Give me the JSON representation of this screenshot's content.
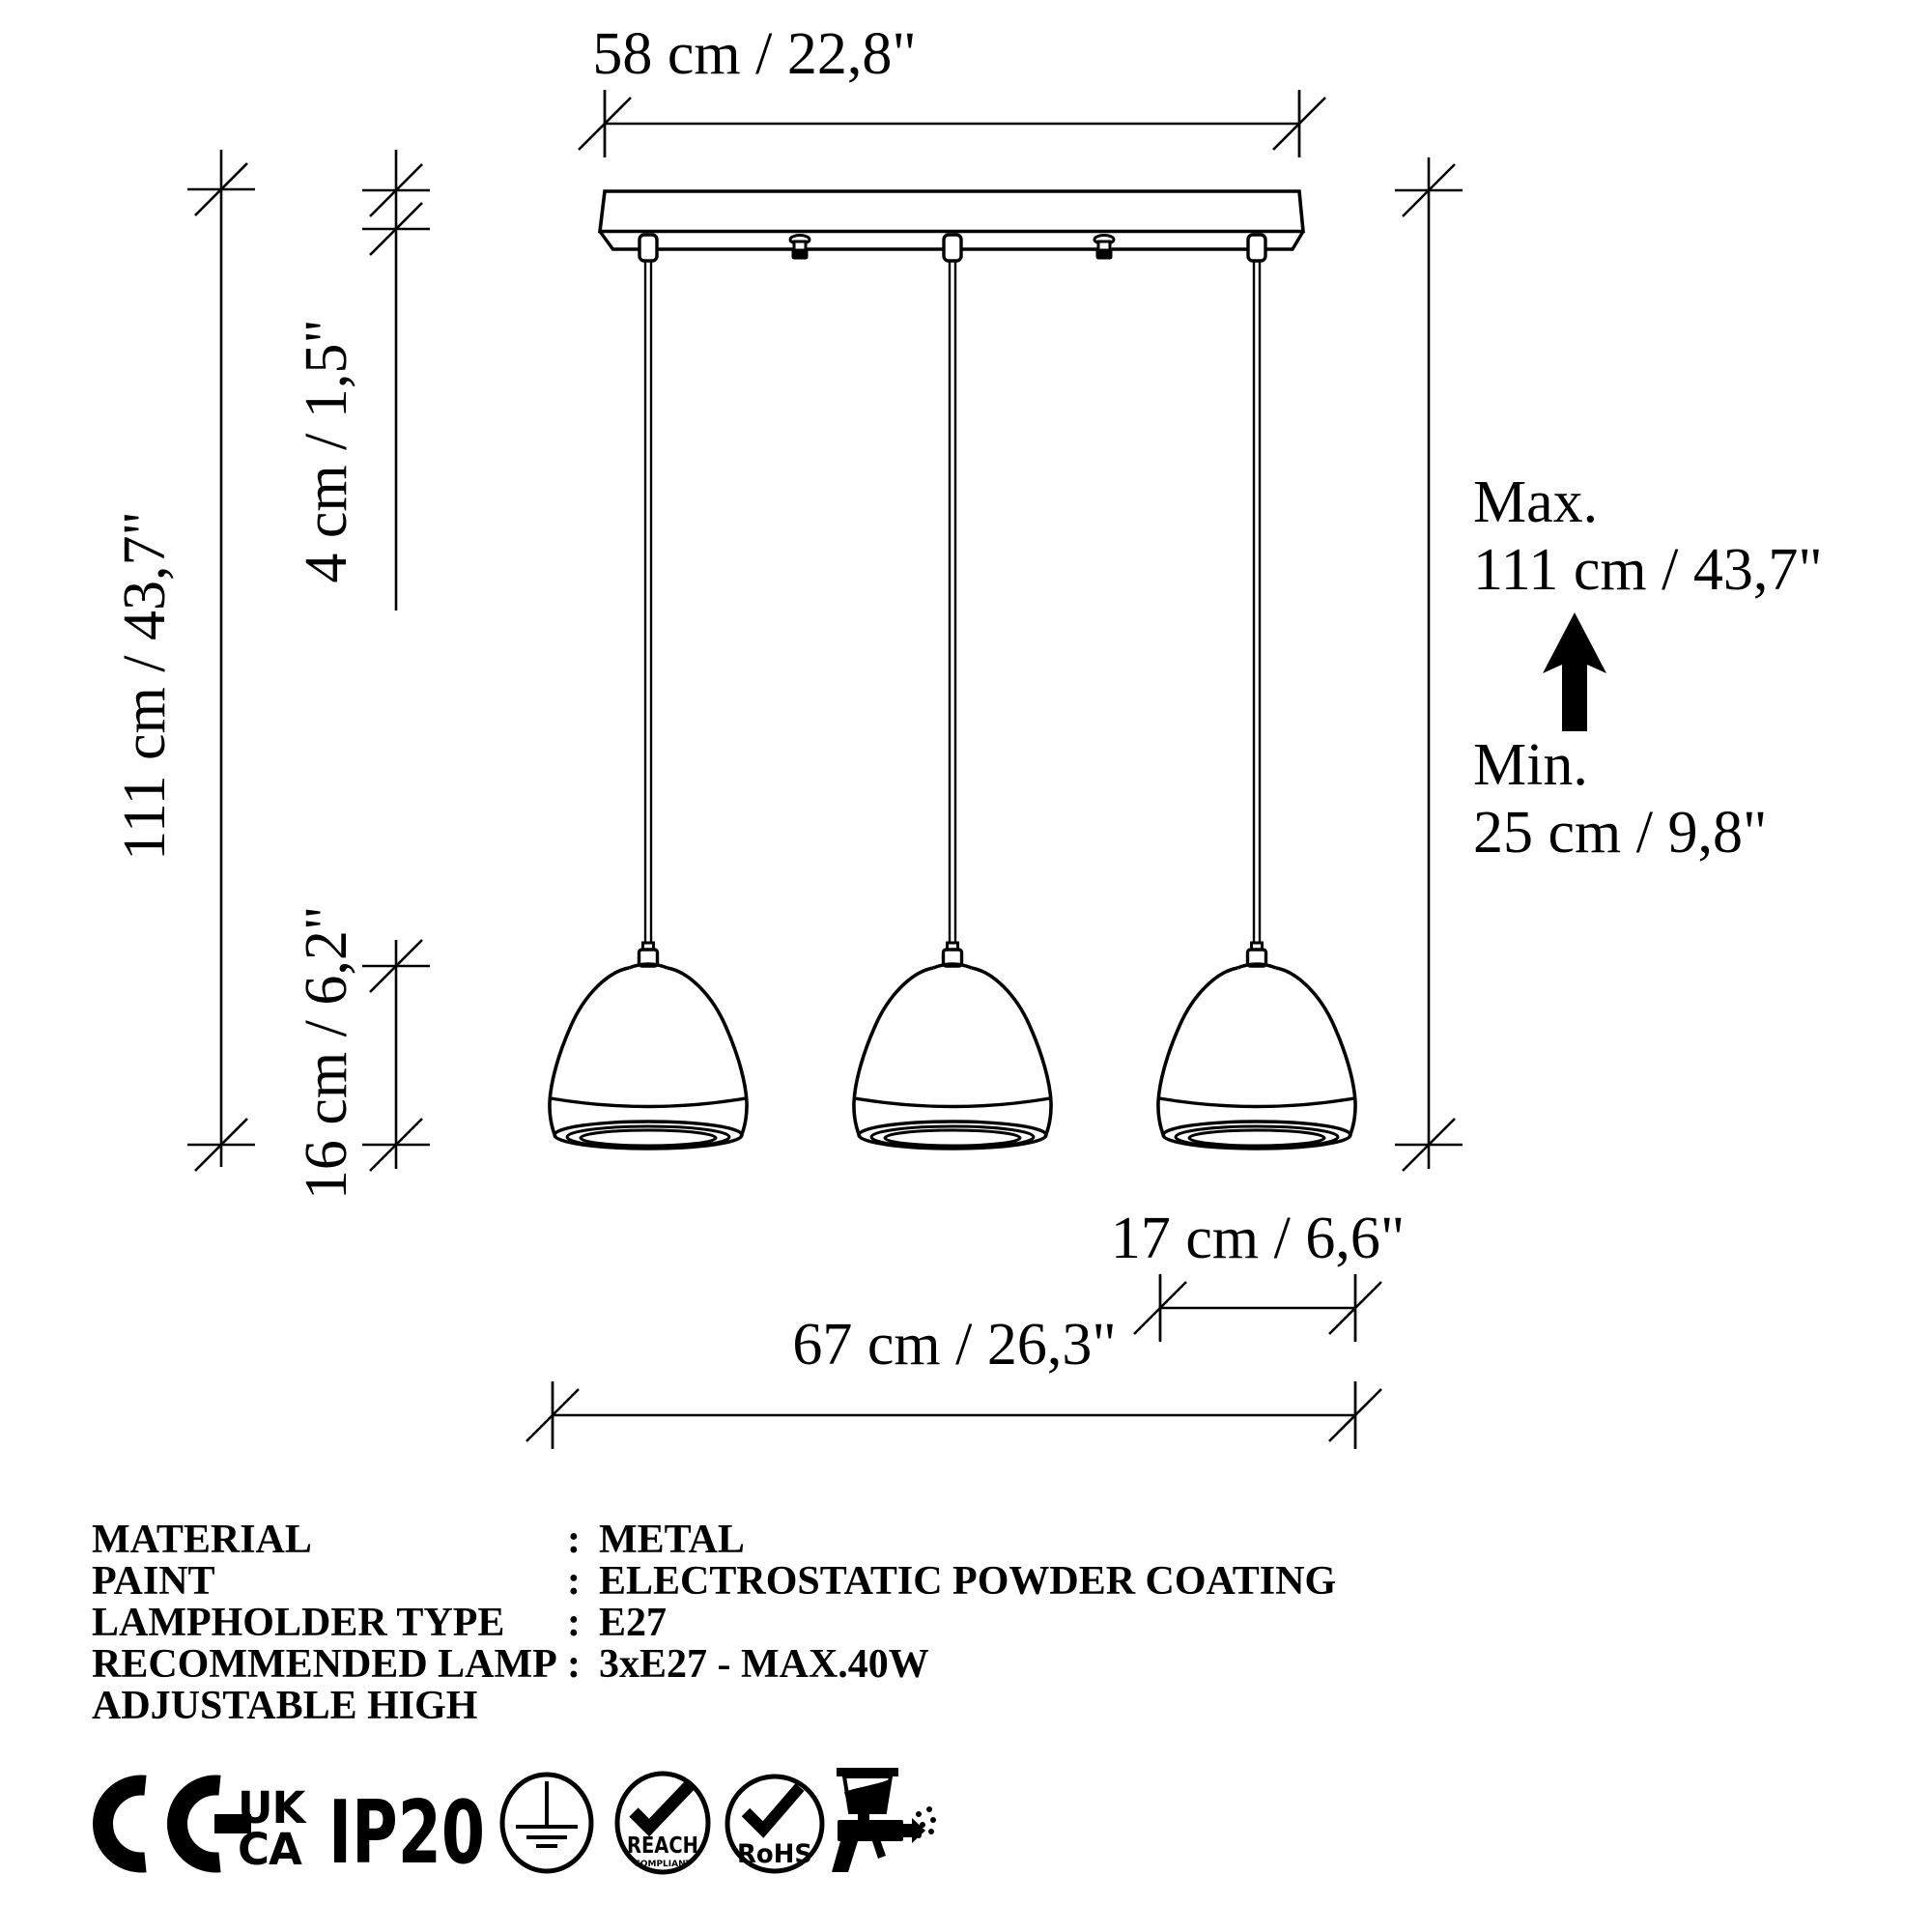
{
  "diagram": {
    "dim_canopy_width": "58 cm / 22,8\"",
    "dim_canopy_height": "4 cm / 1,5\"",
    "dim_overall_height": "111 cm / 43,7\"",
    "dim_shade_height": "16 cm / 6,2\"",
    "dim_shade_width": "17 cm / 6,6\"",
    "dim_total_width": "67 cm / 26,3\"",
    "max_label": "Max.",
    "max_value": "111 cm / 43,7\"",
    "min_label": "Min.",
    "min_value": "25 cm / 9,8\""
  },
  "specs": {
    "rows": [
      {
        "label": "MATERIAL",
        "sep": ":",
        "value": "METAL"
      },
      {
        "label": "PAINT",
        "sep": ":",
        "value": "ELECTROSTATIC POWDER COATING"
      },
      {
        "label": "LAMPHOLDER TYPE",
        "sep": ":",
        "value": "E27"
      },
      {
        "label": "RECOMMENDED LAMP",
        "sep": ":",
        "value": "3xE27 - MAX.40W"
      },
      {
        "label": "ADJUSTABLE HIGH",
        "sep": "",
        "value": ""
      }
    ]
  },
  "certifications": {
    "ce": "CE",
    "ukca_line1": "UK",
    "ukca_line2": "CA",
    "ip_rating": "IP20",
    "reach": "REACH",
    "reach_sub": "COMPLIANT",
    "rohs": "RoHS"
  },
  "colors": {
    "ink": "#000000",
    "paper": "#ffffff"
  }
}
